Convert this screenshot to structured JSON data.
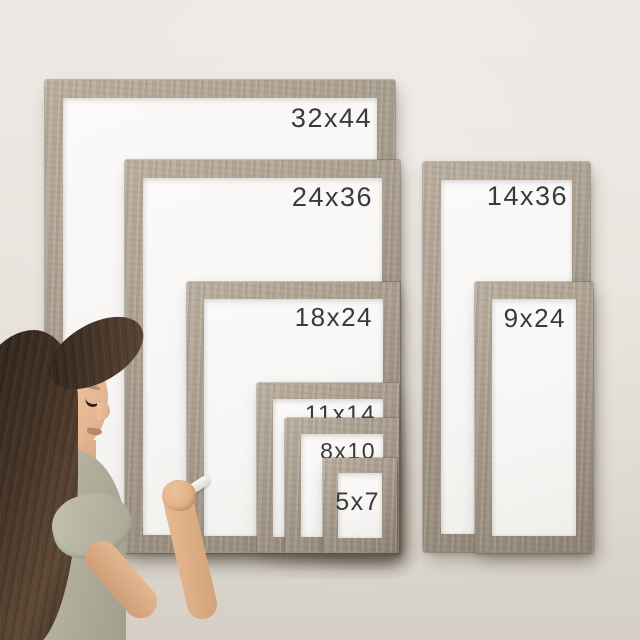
{
  "scene": {
    "description": "Woman with long dark hair in a sage t-shirt writing with a marker on wall-mounted rustic wood framed whiteboards shown in eight sizes"
  },
  "frames": [
    {
      "id": "32x44",
      "label": "32x44"
    },
    {
      "id": "24x36",
      "label": "24x36"
    },
    {
      "id": "18x24",
      "label": "18x24"
    },
    {
      "id": "11x14",
      "label": "11x14"
    },
    {
      "id": "8x10",
      "label": "8x10"
    },
    {
      "id": "5x7",
      "label": "5x7"
    },
    {
      "id": "14x36",
      "label": "14x36"
    },
    {
      "id": "9x24",
      "label": "9x24"
    }
  ],
  "colors": {
    "wall": "#e7e2db",
    "wood": "#a59a8b",
    "wood_light": "#bdb2a2",
    "wood_dark": "#8e8374",
    "whiteboard": "#f6f5f3",
    "label_text": "#3a3a3a",
    "hair": "#46362b",
    "skin": "#e4b894",
    "shirt": "#b7b5a2"
  }
}
